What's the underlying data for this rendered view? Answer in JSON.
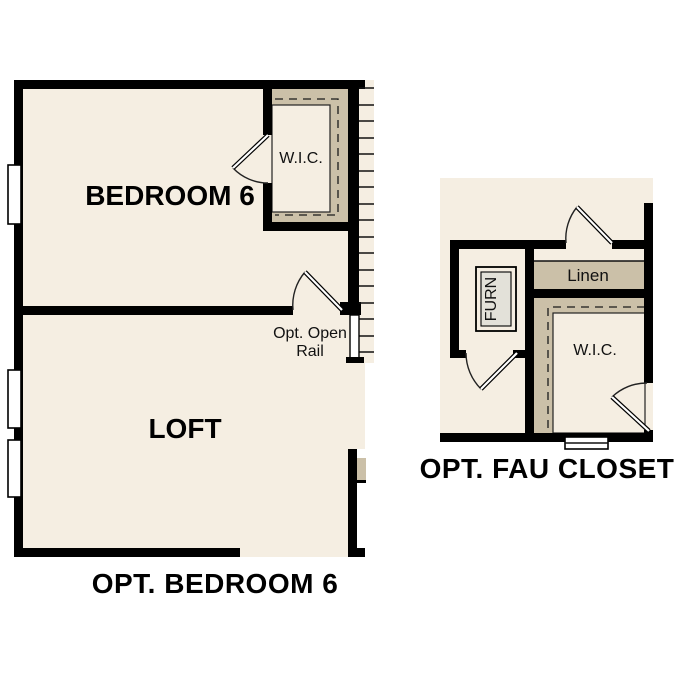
{
  "page": {
    "background": "#ffffff",
    "description_labels": {
      "left_caption": "OPT. BEDROOM 6",
      "right_caption": "OPT. FAU CLOSET"
    }
  },
  "colors": {
    "floor": "#f5eee2",
    "closet_band": "#cbc0a8",
    "wall": "#000000",
    "furnace_fill": "#e3e1d9"
  },
  "left_plan": {
    "caption": "OPT. BEDROOM 6",
    "rooms": {
      "bedroom": {
        "label": "BEDROOM 6"
      },
      "loft": {
        "label": "LOFT"
      },
      "wic": {
        "label": "W.I.C."
      }
    },
    "notes": {
      "rail_line1": "Opt. Open",
      "rail_line2": "Rail"
    }
  },
  "right_plan": {
    "caption": "OPT. FAU CLOSET",
    "rooms": {
      "furnace": {
        "label": "FURN"
      },
      "linen": {
        "label": "Linen"
      },
      "wic": {
        "label": "W.I.C."
      }
    }
  }
}
